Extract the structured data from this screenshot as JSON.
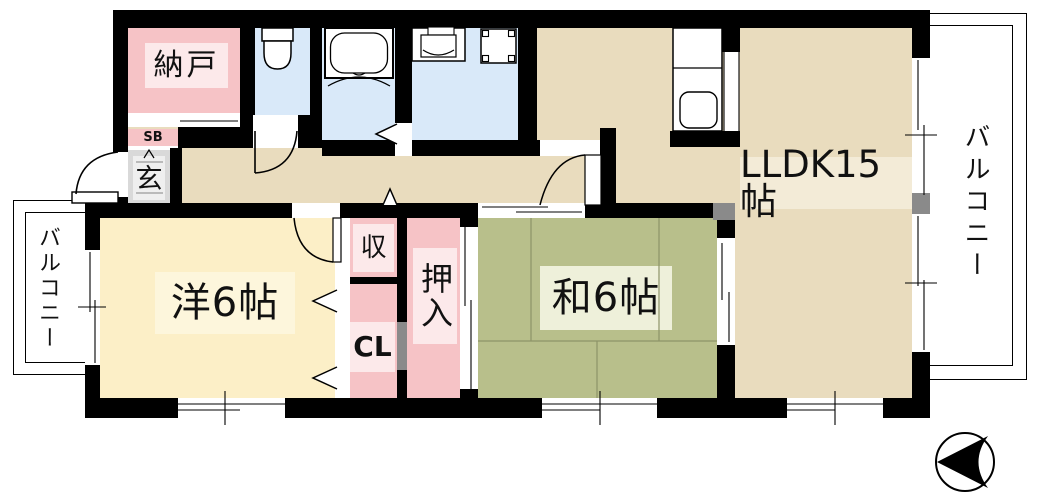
{
  "floorplan": {
    "title": "apartment-floor-plan",
    "rooms": {
      "nando": {
        "label": "納戸"
      },
      "shoe_box": {
        "label": "SB"
      },
      "genkan": {
        "label": "玄"
      },
      "western_room": {
        "label": "洋6帖"
      },
      "storage": {
        "label": "収"
      },
      "closet": {
        "label": "CL"
      },
      "oshiire": {
        "label": "押入"
      },
      "japanese_room": {
        "label": "和6帖"
      },
      "living": {
        "label": "LLDK15帖"
      },
      "balcony_left": {
        "label": "バルコニー"
      },
      "balcony_right": {
        "label": "バルコニー"
      }
    },
    "colors": {
      "wall": "#000000",
      "flooring": "#e9dcbe",
      "western_room": "#fcefc7",
      "tatami_green": "#b8bf8b",
      "storage_pink": "#f6c3c6",
      "wet_area_blue": "#d9e9f9",
      "entrance_gray": "#d9d9d9",
      "label_bg_beige": "#f3ebd7"
    },
    "fixtures": [
      "toilet",
      "bathtub",
      "washbasin",
      "washing-machine-pan",
      "kitchen-sink",
      "compass-north-arrow"
    ]
  }
}
